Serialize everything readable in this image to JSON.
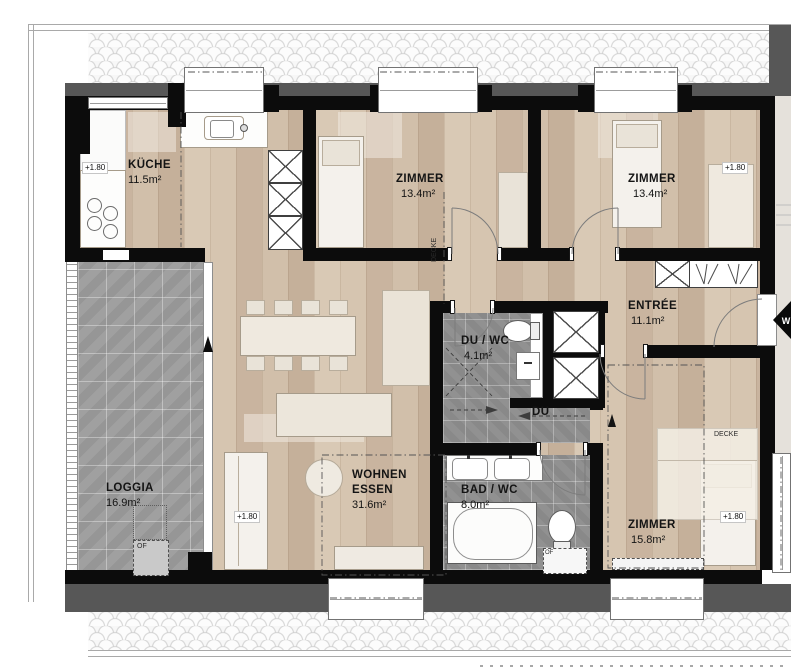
{
  "plan": {
    "title": "Wohnungsgrundriss 4.5 Zimmer",
    "rooms": [
      {
        "id": "kueche",
        "name": "KÜCHE",
        "area": "11.5m²"
      },
      {
        "id": "zimmer-top-mid",
        "name": "ZIMMER",
        "area": "13.4m²"
      },
      {
        "id": "zimmer-top-right",
        "name": "ZIMMER",
        "area": "13.4m²"
      },
      {
        "id": "entree",
        "name": "ENTRÉE",
        "area": "11.1m²"
      },
      {
        "id": "du-wc",
        "name": "DU / WC",
        "area": "4.1m²"
      },
      {
        "id": "wohnen-essen",
        "name": "WOHNEN",
        "name2": "ESSEN",
        "area": "31.6m²"
      },
      {
        "id": "bad-wc",
        "name": "BAD / WC",
        "area": "8.0m²"
      },
      {
        "id": "loggia",
        "name": "LOGGIA",
        "area": "16.9m²"
      },
      {
        "id": "zimmer-bottom-right",
        "name": "ZIMMER",
        "area": "15.8m²"
      }
    ],
    "annotations": {
      "du": "DU",
      "decke": "DECKE",
      "of": "OF",
      "level": "+1.80",
      "entry": "W"
    },
    "colors": {
      "wall": "#0c0c0c",
      "wood": "#cdbaa5",
      "tile": "#8f8f8f",
      "loggia_tile": "#9a9a9a",
      "facade_band": "#575757",
      "scallop_edge": "#cfcfcf"
    }
  }
}
